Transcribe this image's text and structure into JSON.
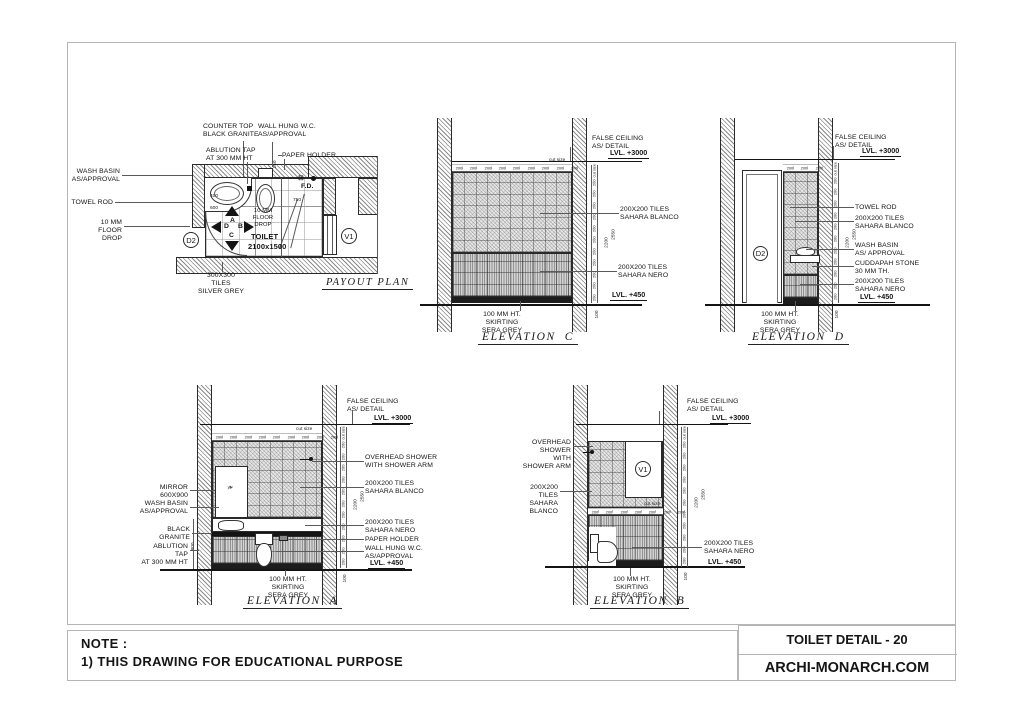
{
  "page": {
    "note_heading": "NOTE :",
    "note_body": "1) THIS DRAWING FOR EDUCATIONAL PURPOSE",
    "title_block": {
      "drawing_title": "TOILET DETAIL - 20",
      "brand": "ARCHI-MONARCH.COM"
    }
  },
  "plan": {
    "title": "PAYOUT PLAN",
    "room_name": "TOILET",
    "room_size": "2100x1500",
    "door_tag": "D2",
    "vent_tag": "V1",
    "floor_drain": "F.D.",
    "view_arrows": {
      "up": "A",
      "right": "B",
      "down": "C",
      "left": "D"
    },
    "labels": {
      "counter_top": "COUNTER TOP\nBLACK GRANITE",
      "wall_hung_wc": "WALL HUNG W.C.\nAS/APPROVAL",
      "ablution_tap": "ABLUTION TAP\nAT 300 MM HT",
      "paper_holder": "PAPER HOLDER",
      "wash_basin": "WASH BASIN\nAS/APPROVAL",
      "towel_rod": "TOWEL ROD",
      "floor_drop": "10 MM\nFLOOR DROP",
      "floor_tiles": "300X300 TILES\nSILVER GREY"
    },
    "dims": {
      "basin_w": "400",
      "counter_w": "600",
      "right_bay": "750",
      "wc_gap": "150"
    }
  },
  "common": {
    "false_ceiling": "FALSE CEILING\nAS/ DETAIL",
    "lvl_ceiling": "LVL. +3000",
    "lvl_floor": "LVL. +450",
    "skirting": "100 MM HT. SKIRTING\nSERA GREY",
    "tiles_blanco": "200X200 TILES\nSAHARA BLANCO",
    "tiles_nero": "200X200 TILES\nSAHARA NERO",
    "dim_cut": "cut size",
    "dim_total": "2550",
    "dim_inner": "2200",
    "dim_floor": "100",
    "side_dims": [
      "cut size",
      "200",
      "200",
      "200",
      "200",
      "200",
      "200",
      "200",
      "200",
      "200",
      "200",
      "200"
    ]
  },
  "elev_c": {
    "title": "ELEVATION  C",
    "top_dims": [
      "200",
      "200",
      "200",
      "200",
      "200",
      "200",
      "200",
      "200",
      "200"
    ]
  },
  "elev_d": {
    "title": "ELEVATION  D",
    "door_tag": "D2",
    "towel_rod": "TOWEL ROD",
    "wash_basin": "WASH BASIN\nAS/ APPROVAL",
    "cuddapah": "CUDDAPAH STONE\n30 MM TH.",
    "top_dims": [
      "200",
      "200",
      "200"
    ]
  },
  "elev_a": {
    "title": "ELEVATION  A",
    "overhead_shower": "OVERHEAD SHOWER\nWITH SHOWER ARM",
    "mirror": "MIRROR\n600X900",
    "wash_basin": "WASH BASIN\nAS/APPROVAL",
    "black_granite": "BLACK\nGRANITE",
    "ablution_tap": "ABLUTION TAP\nAT 300 MM HT",
    "paper_holder": "PAPER HOLDER",
    "wall_hung_wc": "WALL HUNG W.C.\nAS/APPROVAL",
    "counter_height": "800",
    "top_dims": [
      "200",
      "200",
      "200",
      "200",
      "200",
      "200",
      "200",
      "200",
      "200"
    ]
  },
  "elev_b": {
    "title": "ELEVATION  B",
    "overhead_shower": "OVERHEAD SHOWER\nWITH SHOWER ARM",
    "vent_tag": "V1",
    "mid_dims": [
      "200",
      "200",
      "200",
      "200",
      "200",
      "200",
      "200"
    ]
  }
}
